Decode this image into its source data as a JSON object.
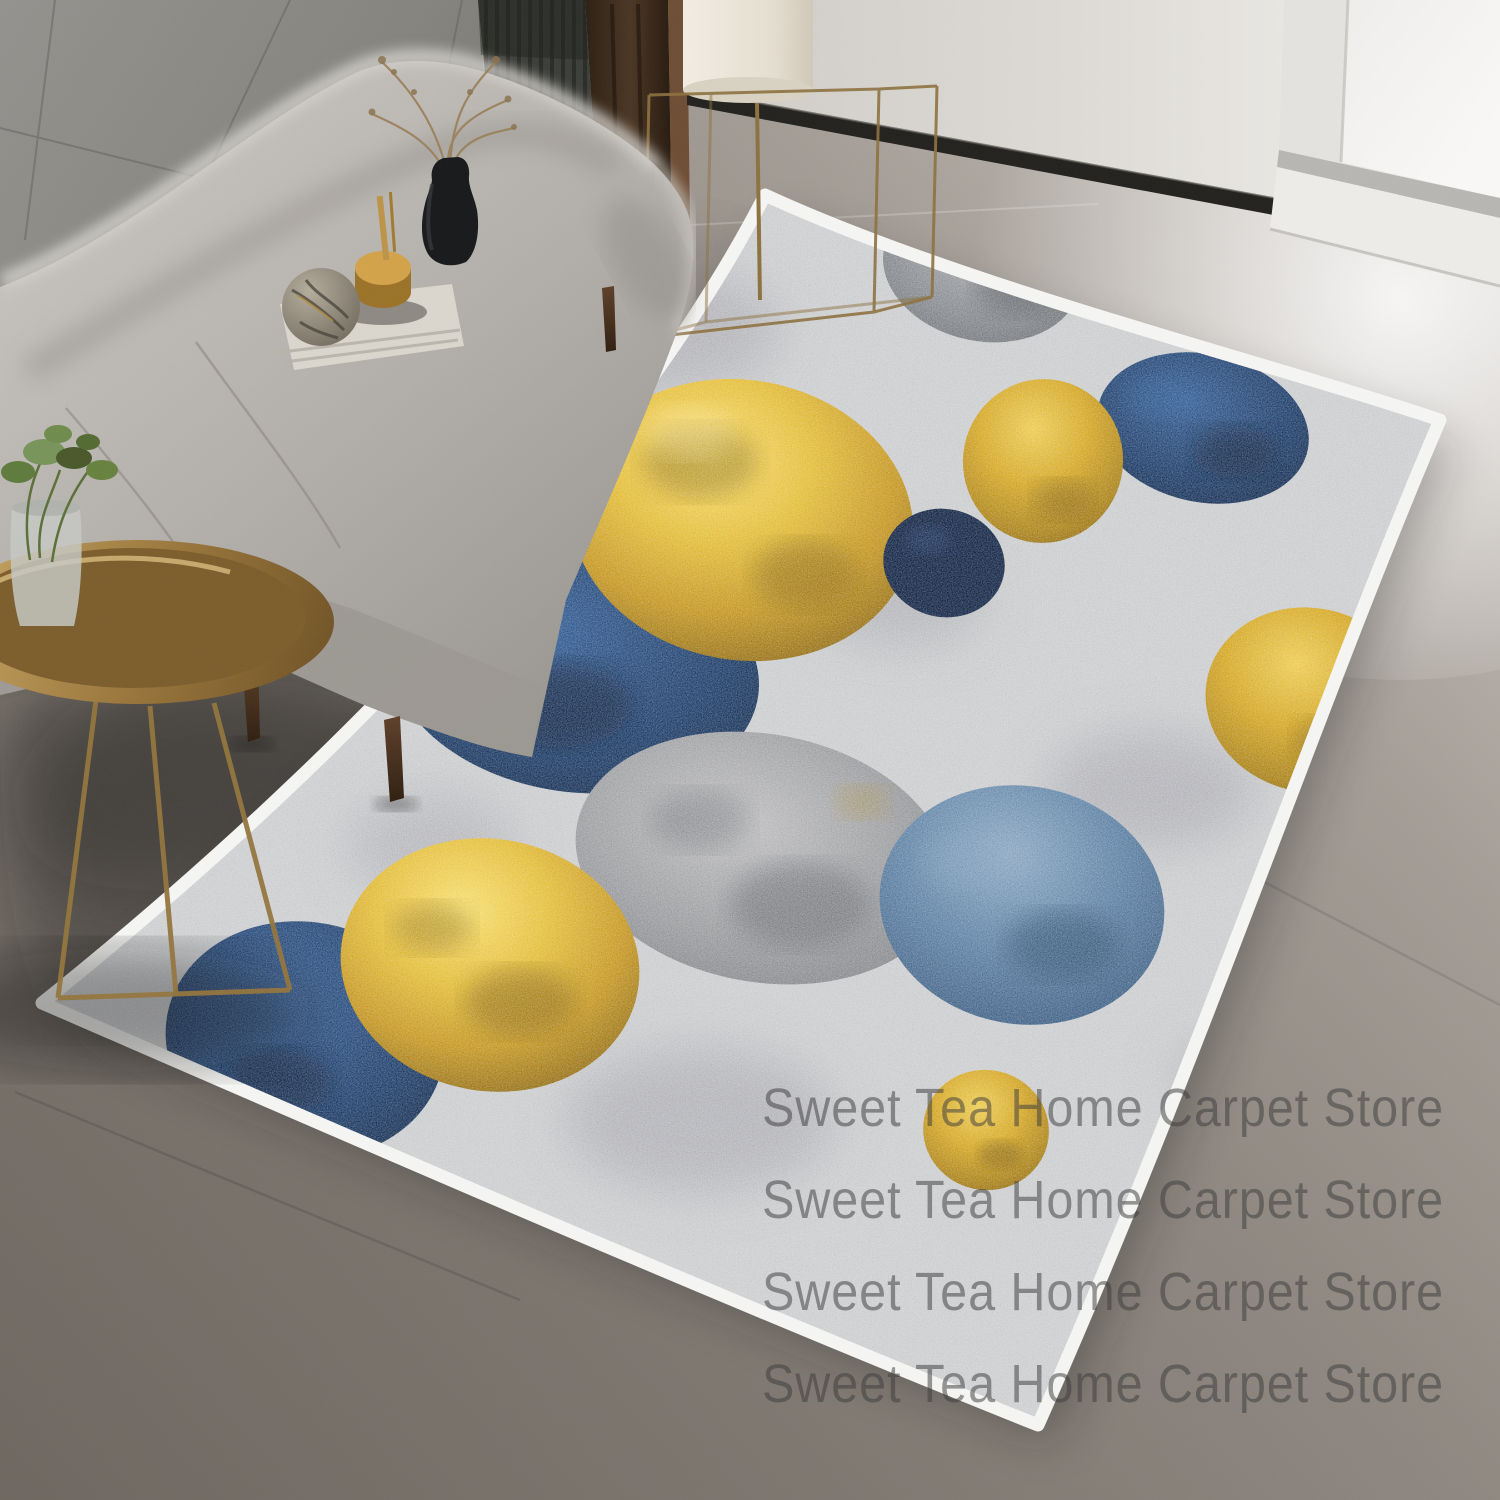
{
  "watermark": {
    "lines": [
      "Sweet Tea Home Carpet Store",
      "Sweet Tea Home Carpet Store",
      "Sweet Tea Home Carpet Store",
      "Sweet Tea Home Carpet Store"
    ]
  },
  "colors": {
    "rug_border": "#f4f4f2",
    "rug_base": "#cbccce",
    "gold": "#d7a61f",
    "gold_dark": "#a87e12",
    "navy": "#1a3e6b",
    "navy_dark": "#0e2142",
    "steel_blue": "#4a6f96",
    "circle_gray": "#8d8e91",
    "floor": "#7a746d",
    "wall_white": "#d9d6d1",
    "tile_wall": "#8a8985",
    "sofa_gray": "#b3b0ab",
    "table_brass": "#a8854a",
    "plant_green": "#67813f",
    "window_light": "#f6f5f2",
    "curtain_brown": "#40301f",
    "baseboard_black": "#23221f"
  },
  "scene": {
    "type": "product-photo",
    "subject": "modern geometric circles area rug with white border",
    "setting": "living room with gray sofa, brass side table, floor lamp and bright window",
    "objects": [
      "area-rug",
      "circle-pattern",
      "sofa",
      "sofa-decor-tray",
      "black-vase",
      "dried-branches",
      "side-table",
      "potted-plant",
      "floor-lamp",
      "tile-wall",
      "slat-panel",
      "curtain",
      "white-wall",
      "baseboard",
      "window",
      "concrete-floor"
    ]
  }
}
